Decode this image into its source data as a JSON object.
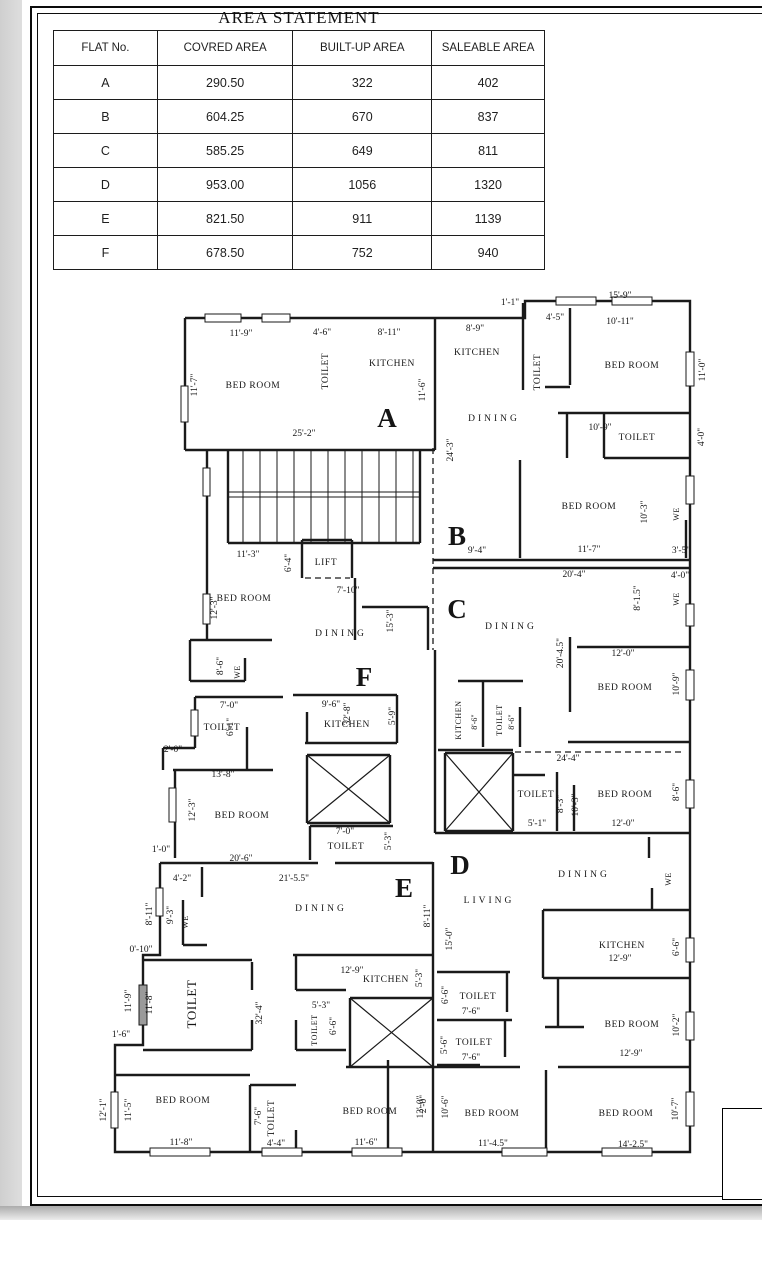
{
  "area_statement": {
    "title": "AREA STATEMENT",
    "headers": [
      "FLAT No.",
      "COVRED AREA",
      "BUILT-UP AREA",
      "SALEABLE AREA"
    ],
    "rows": [
      [
        "A",
        "290.50",
        "322",
        "402"
      ],
      [
        "B",
        "604.25",
        "670",
        "837"
      ],
      [
        "C",
        "585.25",
        "649",
        "811"
      ],
      [
        "D",
        "953.00",
        "1056",
        "1320"
      ],
      [
        "E",
        "821.50",
        "911",
        "1139"
      ],
      [
        "F",
        "678.50",
        "752",
        "940"
      ]
    ]
  },
  "title_block": {
    "lines": [
      "ISAK",
      "SU",
      "REGI",
      "RAJAR"
    ]
  },
  "plan": {
    "labels": [
      {
        "t": "A",
        "x": 387,
        "y": 427,
        "k": "flat"
      },
      {
        "t": "B",
        "x": 457,
        "y": 545,
        "k": "flat"
      },
      {
        "t": "C",
        "x": 457,
        "y": 618,
        "k": "flat"
      },
      {
        "t": "D",
        "x": 460,
        "y": 874,
        "k": "flat"
      },
      {
        "t": "E",
        "x": 404,
        "y": 897,
        "k": "flat"
      },
      {
        "t": "F",
        "x": 364,
        "y": 686,
        "k": "flat"
      },
      {
        "t": "BED ROOM",
        "x": 253,
        "y": 388,
        "k": "room"
      },
      {
        "t": "TOILET",
        "x": 328,
        "y": 371,
        "k": "room",
        "r": 1
      },
      {
        "t": "KITCHEN",
        "x": 392,
        "y": 366,
        "k": "room"
      },
      {
        "t": "KITCHEN",
        "x": 477,
        "y": 355,
        "k": "room"
      },
      {
        "t": "TOILET",
        "x": 540,
        "y": 372,
        "k": "room",
        "r": 1
      },
      {
        "t": "BED ROOM",
        "x": 632,
        "y": 368,
        "k": "room"
      },
      {
        "t": "DINING",
        "x": 494,
        "y": 421,
        "k": "room",
        "sp": 3
      },
      {
        "t": "TOILET",
        "x": 637,
        "y": 440,
        "k": "room"
      },
      {
        "t": "BED ROOM",
        "x": 589,
        "y": 509,
        "k": "room"
      },
      {
        "t": "BED ROOM",
        "x": 244,
        "y": 601,
        "k": "room"
      },
      {
        "t": "LIFT",
        "x": 326,
        "y": 565,
        "k": "room"
      },
      {
        "t": "DINING",
        "x": 341,
        "y": 636,
        "k": "room",
        "sp": 3
      },
      {
        "t": "DINING",
        "x": 511,
        "y": 629,
        "k": "room",
        "sp": 3
      },
      {
        "t": "BED ROOM",
        "x": 625,
        "y": 690,
        "k": "room"
      },
      {
        "t": "KITCHEN",
        "x": 461,
        "y": 720,
        "k": "room",
        "r": 1,
        "s": 8
      },
      {
        "t": "TOILET",
        "x": 502,
        "y": 720,
        "k": "room",
        "r": 1,
        "s": 8
      },
      {
        "t": "TOILET",
        "x": 222,
        "y": 730,
        "k": "room"
      },
      {
        "t": "KITCHEN",
        "x": 347,
        "y": 727,
        "k": "room"
      },
      {
        "t": "BED ROOM",
        "x": 242,
        "y": 818,
        "k": "room"
      },
      {
        "t": "TOILET",
        "x": 346,
        "y": 849,
        "k": "room"
      },
      {
        "t": "TOILET",
        "x": 536,
        "y": 797,
        "k": "room"
      },
      {
        "t": "BED ROOM",
        "x": 625,
        "y": 797,
        "k": "room"
      },
      {
        "t": "DINING",
        "x": 584,
        "y": 877,
        "k": "room",
        "sp": 3
      },
      {
        "t": "LIVING",
        "x": 489,
        "y": 903,
        "k": "room",
        "sp": 3
      },
      {
        "t": "KITCHEN",
        "x": 622,
        "y": 948,
        "k": "room"
      },
      {
        "t": "BED ROOM",
        "x": 632,
        "y": 1027,
        "k": "room"
      },
      {
        "t": "DINING",
        "x": 321,
        "y": 911,
        "k": "room",
        "sp": 3
      },
      {
        "t": "KITCHEN",
        "x": 386,
        "y": 982,
        "k": "room"
      },
      {
        "t": "TOILET",
        "x": 317,
        "y": 1030,
        "k": "room",
        "r": 1,
        "s": 8
      },
      {
        "t": "TOILET",
        "x": 196,
        "y": 1004,
        "k": "room",
        "r": 1,
        "s": 13
      },
      {
        "t": "TOILET",
        "x": 478,
        "y": 999,
        "k": "room"
      },
      {
        "t": "TOILET",
        "x": 474,
        "y": 1045,
        "k": "room"
      },
      {
        "t": "BED ROOM",
        "x": 183,
        "y": 1103,
        "k": "room"
      },
      {
        "t": "TOILET",
        "x": 274,
        "y": 1118,
        "k": "room",
        "r": 1
      },
      {
        "t": "BED ROOM",
        "x": 370,
        "y": 1114,
        "k": "room"
      },
      {
        "t": "BED ROOM",
        "x": 492,
        "y": 1116,
        "k": "room"
      },
      {
        "t": "BED ROOM",
        "x": 626,
        "y": 1116,
        "k": "room"
      },
      {
        "t": "11'-9\"",
        "x": 241,
        "y": 336,
        "k": "dim"
      },
      {
        "t": "4'-6\"",
        "x": 322,
        "y": 335,
        "k": "dim"
      },
      {
        "t": "8'-11\"",
        "x": 389,
        "y": 335,
        "k": "dim"
      },
      {
        "t": "8'-9\"",
        "x": 475,
        "y": 331,
        "k": "dim"
      },
      {
        "t": "1'-1\"",
        "x": 510,
        "y": 305,
        "k": "dim"
      },
      {
        "t": "4'-5\"",
        "x": 555,
        "y": 320,
        "k": "dim"
      },
      {
        "t": "15'-9\"",
        "x": 620,
        "y": 298,
        "k": "dim"
      },
      {
        "t": "10'-11\"",
        "x": 620,
        "y": 324,
        "k": "dim"
      },
      {
        "t": "25'-2\"",
        "x": 304,
        "y": 436,
        "k": "dim"
      },
      {
        "t": "10'-9\"",
        "x": 600,
        "y": 430,
        "k": "dim"
      },
      {
        "t": "11'-3\"",
        "x": 248,
        "y": 557,
        "k": "dim"
      },
      {
        "t": "9'-4\"",
        "x": 477,
        "y": 553,
        "k": "dim"
      },
      {
        "t": "11'-7\"",
        "x": 589,
        "y": 552,
        "k": "dim"
      },
      {
        "t": "3'-5\"",
        "x": 681,
        "y": 553,
        "k": "dim"
      },
      {
        "t": "20'-4\"",
        "x": 574,
        "y": 577,
        "k": "dim"
      },
      {
        "t": "4'-0\"",
        "x": 680,
        "y": 578,
        "k": "dim"
      },
      {
        "t": "7'-10\"",
        "x": 348,
        "y": 593,
        "k": "dim"
      },
      {
        "t": "12'-0\"",
        "x": 623,
        "y": 656,
        "k": "dim"
      },
      {
        "t": "7'-0\"",
        "x": 229,
        "y": 708,
        "k": "dim"
      },
      {
        "t": "9'-6\"",
        "x": 331,
        "y": 707,
        "k": "dim"
      },
      {
        "t": "2'-0\"",
        "x": 173,
        "y": 752,
        "k": "dim"
      },
      {
        "t": "13'-8\"",
        "x": 223,
        "y": 777,
        "k": "dim"
      },
      {
        "t": "24'-4\"",
        "x": 568,
        "y": 761,
        "k": "dim"
      },
      {
        "t": "5'-1\"",
        "x": 537,
        "y": 826,
        "k": "dim"
      },
      {
        "t": "12'-0\"",
        "x": 623,
        "y": 826,
        "k": "dim"
      },
      {
        "t": "7'-0\"",
        "x": 345,
        "y": 834,
        "k": "dim"
      },
      {
        "t": "1'-0\"",
        "x": 161,
        "y": 852,
        "k": "dim"
      },
      {
        "t": "20'-6\"",
        "x": 241,
        "y": 861,
        "k": "dim"
      },
      {
        "t": "4'-2\"",
        "x": 182,
        "y": 881,
        "k": "dim"
      },
      {
        "t": "21'-5.5\"",
        "x": 294,
        "y": 881,
        "k": "dim"
      },
      {
        "t": "0'-10\"",
        "x": 141,
        "y": 952,
        "k": "dim"
      },
      {
        "t": "12'-9\"",
        "x": 352,
        "y": 973,
        "k": "dim"
      },
      {
        "t": "12'-9\"",
        "x": 620,
        "y": 961,
        "k": "dim"
      },
      {
        "t": "5'-3\"",
        "x": 321,
        "y": 1008,
        "k": "dim"
      },
      {
        "t": "7'-6\"",
        "x": 471,
        "y": 1014,
        "k": "dim"
      },
      {
        "t": "7'-6\"",
        "x": 471,
        "y": 1060,
        "k": "dim"
      },
      {
        "t": "12'-9\"",
        "x": 631,
        "y": 1056,
        "k": "dim"
      },
      {
        "t": "1'-6\"",
        "x": 121,
        "y": 1037,
        "k": "dim"
      },
      {
        "t": "11'-8\"",
        "x": 181,
        "y": 1145,
        "k": "dim"
      },
      {
        "t": "4'-4\"",
        "x": 276,
        "y": 1146,
        "k": "dim"
      },
      {
        "t": "11'-6\"",
        "x": 366,
        "y": 1145,
        "k": "dim"
      },
      {
        "t": "11'-4.5\"",
        "x": 493,
        "y": 1146,
        "k": "dim"
      },
      {
        "t": "14'-2.5\"",
        "x": 633,
        "y": 1147,
        "k": "dim"
      },
      {
        "t": "11'-7\"",
        "x": 197,
        "y": 385,
        "k": "dim",
        "r": 1
      },
      {
        "t": "11'-6\"",
        "x": 425,
        "y": 390,
        "k": "dim",
        "r": 1
      },
      {
        "t": "11'-0\"",
        "x": 705,
        "y": 370,
        "k": "dim",
        "r": 1
      },
      {
        "t": "24'-3\"",
        "x": 453,
        "y": 450,
        "k": "dim",
        "r": 1
      },
      {
        "t": "4'-0\"",
        "x": 704,
        "y": 437,
        "k": "dim",
        "r": 1
      },
      {
        "t": "6'-4\"",
        "x": 291,
        "y": 563,
        "k": "dim",
        "r": 1
      },
      {
        "t": "12'-3\"",
        "x": 217,
        "y": 608,
        "k": "dim",
        "r": 1
      },
      {
        "t": "15'-3\"",
        "x": 393,
        "y": 621,
        "k": "dim",
        "r": 1
      },
      {
        "t": "10'-3\"",
        "x": 647,
        "y": 512,
        "k": "dim",
        "r": 1
      },
      {
        "t": "8'-1.5\"",
        "x": 640,
        "y": 598,
        "k": "dim",
        "r": 1
      },
      {
        "t": "10'-9\"",
        "x": 679,
        "y": 684,
        "k": "dim",
        "r": 1
      },
      {
        "t": "20'-4.5\"",
        "x": 563,
        "y": 653,
        "k": "dim",
        "r": 1
      },
      {
        "t": "8'-6\"",
        "x": 223,
        "y": 666,
        "k": "dim",
        "r": 1
      },
      {
        "t": "32'-8\"",
        "x": 350,
        "y": 714,
        "k": "dim",
        "r": 1
      },
      {
        "t": "5'-9\"",
        "x": 395,
        "y": 716,
        "k": "dim",
        "r": 1
      },
      {
        "t": "6'-1\"",
        "x": 233,
        "y": 727,
        "k": "dim",
        "r": 1
      },
      {
        "t": "8'-6\"",
        "x": 477,
        "y": 722,
        "k": "dim",
        "r": 1,
        "s": 8
      },
      {
        "t": "8'-6\"",
        "x": 514,
        "y": 722,
        "k": "dim",
        "r": 1,
        "s": 8
      },
      {
        "t": "12'-3\"",
        "x": 195,
        "y": 810,
        "k": "dim",
        "r": 1
      },
      {
        "t": "5'-3\"",
        "x": 391,
        "y": 841,
        "k": "dim",
        "r": 1
      },
      {
        "t": "8'-3\"",
        "x": 563,
        "y": 804,
        "k": "dim",
        "r": 1
      },
      {
        "t": "10'-3\"",
        "x": 578,
        "y": 805,
        "k": "dim",
        "r": 1
      },
      {
        "t": "8'-6\"",
        "x": 679,
        "y": 792,
        "k": "dim",
        "r": 1
      },
      {
        "t": "8'-11\"",
        "x": 152,
        "y": 914,
        "k": "dim",
        "r": 1
      },
      {
        "t": "9'-3\"",
        "x": 173,
        "y": 915,
        "k": "dim",
        "r": 1
      },
      {
        "t": "8'-11\"",
        "x": 430,
        "y": 916,
        "k": "dim",
        "r": 1
      },
      {
        "t": "15'-0\"",
        "x": 452,
        "y": 939,
        "k": "dim",
        "r": 1
      },
      {
        "t": "6'-6\"",
        "x": 679,
        "y": 947,
        "k": "dim",
        "r": 1
      },
      {
        "t": "11'-9\"",
        "x": 131,
        "y": 1001,
        "k": "dim",
        "r": 1
      },
      {
        "t": "11'-8\"",
        "x": 152,
        "y": 1003,
        "k": "dim",
        "r": 1
      },
      {
        "t": "32'-4\"",
        "x": 262,
        "y": 1013,
        "k": "dim",
        "r": 1
      },
      {
        "t": "5'-3\"",
        "x": 422,
        "y": 978,
        "k": "dim",
        "r": 1
      },
      {
        "t": "6'-6\"",
        "x": 336,
        "y": 1026,
        "k": "dim",
        "r": 1
      },
      {
        "t": "6'-6\"",
        "x": 448,
        "y": 995,
        "k": "dim",
        "r": 1
      },
      {
        "t": "5'-6\"",
        "x": 447,
        "y": 1045,
        "k": "dim",
        "r": 1
      },
      {
        "t": "2'-0\"",
        "x": 426,
        "y": 1104,
        "k": "dim",
        "r": 1
      },
      {
        "t": "10'-2\"",
        "x": 679,
        "y": 1025,
        "k": "dim",
        "r": 1
      },
      {
        "t": "12'-1\"",
        "x": 106,
        "y": 1110,
        "k": "dim",
        "r": 1
      },
      {
        "t": "11'-5\"",
        "x": 131,
        "y": 1110,
        "k": "dim",
        "r": 1
      },
      {
        "t": "7'-6\"",
        "x": 261,
        "y": 1116,
        "k": "dim",
        "r": 1
      },
      {
        "t": "12'-0\"",
        "x": 423,
        "y": 1107,
        "k": "dim",
        "r": 1
      },
      {
        "t": "10'-6\"",
        "x": 448,
        "y": 1107,
        "k": "dim",
        "r": 1
      },
      {
        "t": "10'-7\"",
        "x": 678,
        "y": 1109,
        "k": "dim",
        "r": 1
      },
      {
        "t": "WE",
        "x": 679,
        "y": 514,
        "k": "we",
        "r": 1
      },
      {
        "t": "WE",
        "x": 679,
        "y": 599,
        "k": "we",
        "r": 1
      },
      {
        "t": "WE",
        "x": 240,
        "y": 672,
        "k": "we",
        "r": 1
      },
      {
        "t": "WE",
        "x": 188,
        "y": 922,
        "k": "we",
        "r": 1
      },
      {
        "t": "WE",
        "x": 671,
        "y": 879,
        "k": "we",
        "r": 1
      }
    ]
  }
}
